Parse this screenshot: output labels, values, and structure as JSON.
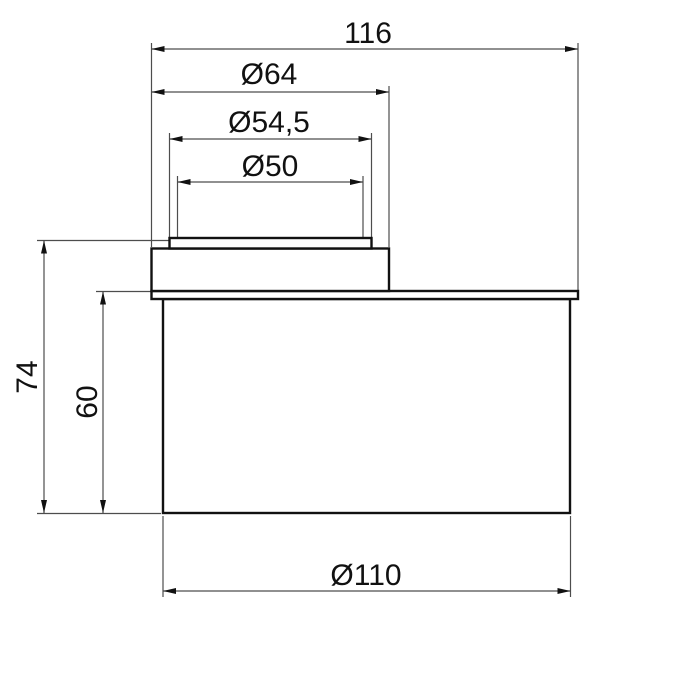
{
  "drawing": {
    "type": "technical-dimension-drawing",
    "view": "side-section-of-eccentric-pipe-fitting",
    "units": "mm"
  },
  "colors": {
    "background": "#ffffff",
    "outline": "#111111",
    "dimension_line": "#4d4d4d",
    "arrow": "#111111",
    "text": "#111111"
  },
  "dimensions": [
    {
      "name": "overall-width",
      "label": "116",
      "value": 116,
      "orientation": "horizontal"
    },
    {
      "name": "collar-diameter",
      "label": "Ø64",
      "value": 64,
      "orientation": "horizontal"
    },
    {
      "name": "rim-outer-diameter",
      "label": "Ø54,5",
      "value": 54.5,
      "orientation": "horizontal"
    },
    {
      "name": "bore-diameter",
      "label": "Ø50",
      "value": 50,
      "orientation": "horizontal"
    },
    {
      "name": "overall-height",
      "label": "74",
      "value": 74,
      "orientation": "vertical"
    },
    {
      "name": "body-height",
      "label": "60",
      "value": 60,
      "orientation": "vertical"
    },
    {
      "name": "body-diameter",
      "label": "Ø110",
      "value": 110,
      "orientation": "horizontal"
    }
  ]
}
